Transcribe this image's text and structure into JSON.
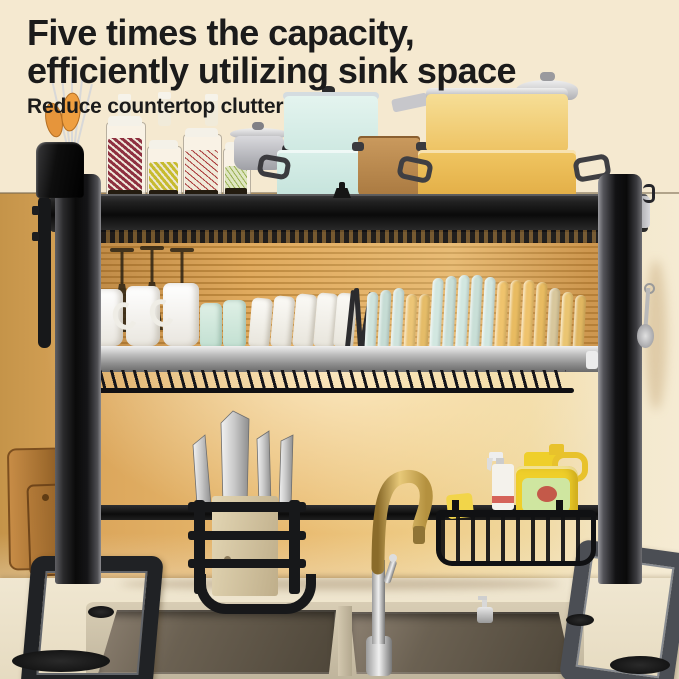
{
  "header": {
    "headline_line1": "Five times the capacity,",
    "headline_line2": "efficiently utilizing sink space",
    "subheadline": "Reduce countertop clutter"
  },
  "palette": {
    "bg_top": "#f5e9d0",
    "wall_amber": "#e2ac5f",
    "counter": "#ece2cb",
    "rack_black": "#141414",
    "shelf_silver": "#b9b9b9",
    "pot_blue": "#d6ede7",
    "pot_yellow": "#f2d483",
    "jug_yellow": "#efcf2a",
    "sponge_yellow": "#f2d549",
    "label_green": "#cfe6a0",
    "faucet_gold": "#c9a44f",
    "sink_steel": "#5c5445",
    "board_wood": "#b97f3e",
    "text": "#1b1b1b"
  },
  "scene": {
    "description": "Black two-tier over-the-sink dish drying rack standing over a double stainless-steel sink on a cream countertop, golden wall glow behind.",
    "top_shelf_items": [
      "utensil-holder with orange spoons and whisks",
      "clear grain jars (red, yellow, white-red, green)",
      "small steel pot with lid",
      "stacked blue pots",
      "brown pot",
      "stacked yellow pots",
      "steel lid"
    ],
    "middle_tier_items": [
      "3 hanging wine glasses",
      "3 white mugs",
      "2 mint cups",
      "5 white cups",
      "dark cutlery",
      "17 upright plates"
    ],
    "lower_items": [
      "2 wooden cutting boards",
      "knife holder with 4 knives",
      "gold gooseneck faucet",
      "wire basket",
      "spray bottle",
      "yellow dish-soap jug",
      "yellow sponge"
    ],
    "bottom_items": [
      "double stainless sink",
      "soap dispenser",
      "black U-shaped rack legs with suction feet"
    ],
    "plates": {
      "items": [
        {
          "c": "#cfe3dc",
          "h": 56
        },
        {
          "c": "#c6dcd4",
          "h": 58
        },
        {
          "c": "#cfe3dc",
          "h": 60
        },
        {
          "c": "#ecc576",
          "h": 54
        },
        {
          "c": "#e5bc68",
          "h": 54
        },
        {
          "c": "#d2e7e0",
          "h": 70
        },
        {
          "c": "#c9dfd7",
          "h": 72
        },
        {
          "c": "#d2e7e0",
          "h": 73
        },
        {
          "c": "#c9dfd7",
          "h": 73
        },
        {
          "c": "#d2e7e0",
          "h": 71
        },
        {
          "c": "#efc36d",
          "h": 67
        },
        {
          "c": "#e8bb61",
          "h": 68
        },
        {
          "c": "#efc36d",
          "h": 68
        },
        {
          "c": "#e8bb61",
          "h": 66
        },
        {
          "c": "#d8c79c",
          "h": 60
        },
        {
          "c": "#eac572",
          "h": 56
        },
        {
          "c": "#e0b660",
          "h": 53
        }
      ]
    }
  }
}
